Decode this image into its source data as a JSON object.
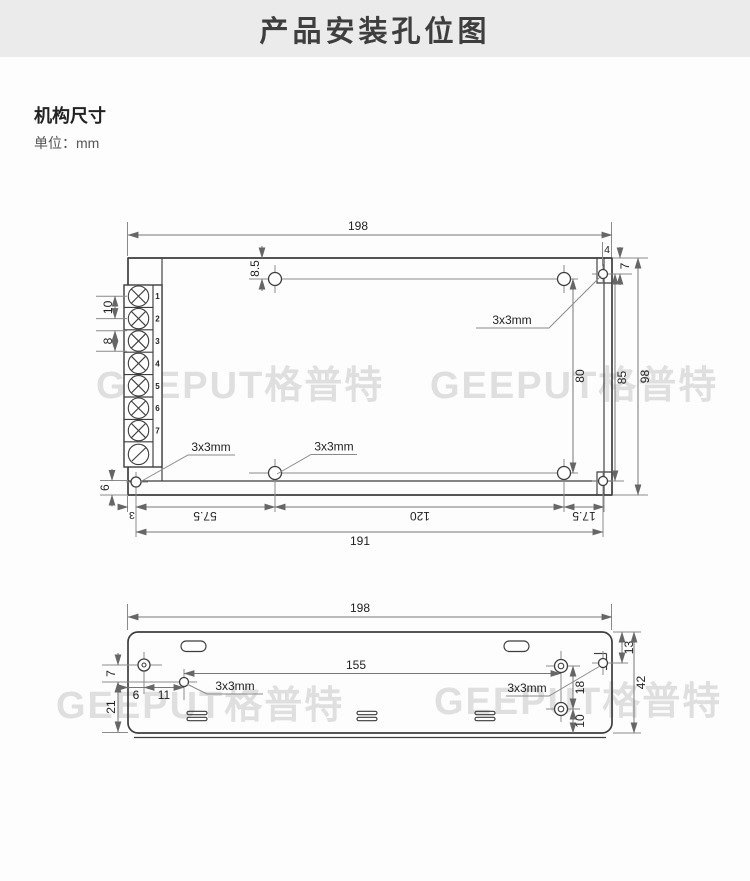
{
  "colors": {
    "header_bg": "#ebebeb",
    "line": "#3d3d3d",
    "dim": "#8a8a8a",
    "textc": "#1f1f1f",
    "watermark": "#dfdfdf"
  },
  "header": {
    "title": "产品安装孔位图"
  },
  "section": {
    "heading": "机构尺寸",
    "unit": "单位：mm"
  },
  "watermark": {
    "text": "GEEPUT格普特"
  },
  "top_view": {
    "hole_note": "3x3mm",
    "terminals": [
      "1",
      "2",
      "3",
      "4",
      "5",
      "6",
      "7"
    ],
    "dims": {
      "w198": "198",
      "n4": "4",
      "n8_5": "8.5",
      "n7": "7",
      "n10": "10",
      "n8": "8",
      "n6": "6",
      "n80": "80",
      "n85": "85",
      "n98": "98",
      "n3": "3",
      "n57_5": "57.5",
      "n120": "120",
      "n17_5": "17.5",
      "n191": "191"
    }
  },
  "bottom_view": {
    "hole_note": "3x3mm",
    "dims": {
      "w198": "198",
      "n155": "155",
      "n13": "13",
      "n42": "42",
      "n7": "7",
      "n6": "6",
      "n11": "11",
      "n21": "21",
      "n18": "18",
      "n10": "10"
    }
  }
}
